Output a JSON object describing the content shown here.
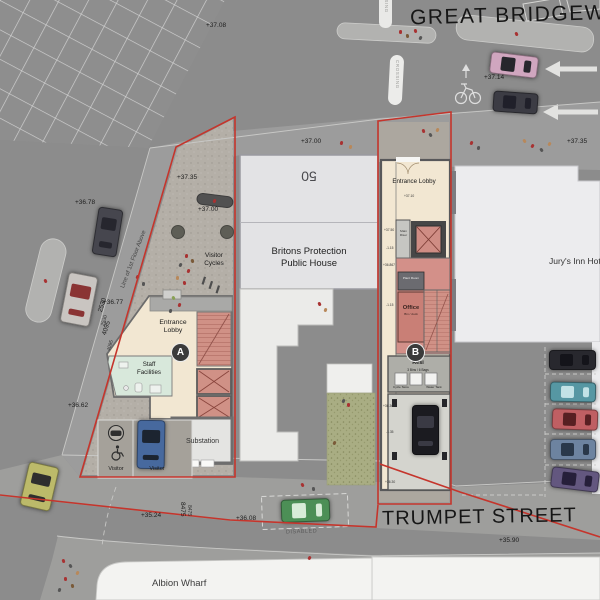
{
  "streets": {
    "top": "GREAT BRIDGEWATER",
    "bottom": "TRUMPET STREET"
  },
  "road": {
    "crossing": "CROSSING",
    "disabled_bay": "DISABLED"
  },
  "buildings": {
    "pub": {
      "number": "50",
      "name1": "Britons Protection",
      "name2": "Public House"
    },
    "hotel": {
      "name": "Jury's Inn Hotel"
    },
    "albion": {
      "name": "Albion Wharf"
    }
  },
  "site_a": {
    "marker": "A",
    "entrance_lobby": "Entrance Lobby",
    "staff_facilities": "Staff Facilities",
    "substation": "Substation",
    "visitor_left": "Visitor",
    "visitor_right": "Visitor",
    "visitor_cycles": "Visitor Cycles",
    "line_note": "Line of 1st Floor Above",
    "dim_edge_1": "2530",
    "dim_edge_2": "4095",
    "dim_street": "8475"
  },
  "site_b": {
    "marker": "B",
    "entrance_lobby": "Entrance Lobby",
    "main_riser": "Main Riser",
    "plant_room": "Plant Room",
    "office": "Office",
    "office_sub": "Bin / dock",
    "resi": "Resi",
    "resi_sub": "3 Bins / 6 Bags",
    "cycle_store": "Cycle Store",
    "water_tank": "Water Tank"
  },
  "levels": [
    {
      "t": "+37.08",
      "x": 206,
      "y": 22,
      "r": 0
    },
    {
      "t": "+37.14",
      "x": 484,
      "y": 74,
      "r": 0
    },
    {
      "t": "+37.35",
      "x": 567,
      "y": 138,
      "r": 0
    },
    {
      "t": "+37.35",
      "x": 177,
      "y": 174,
      "r": 0
    },
    {
      "t": "+37.00",
      "x": 198,
      "y": 206,
      "r": 0
    },
    {
      "t": "+37.00",
      "x": 301,
      "y": 138,
      "r": 0
    },
    {
      "t": "+36.78",
      "x": 75,
      "y": 199,
      "r": 0
    },
    {
      "t": "+36.77",
      "x": 103,
      "y": 299,
      "r": 0
    },
    {
      "t": "+36.62",
      "x": 68,
      "y": 402,
      "r": 0
    },
    {
      "t": "+35.24",
      "x": 141,
      "y": 512,
      "r": 0
    },
    {
      "t": "+36.08",
      "x": 236,
      "y": 515,
      "r": 0
    },
    {
      "t": "+35.90",
      "x": 499,
      "y": 537,
      "r": 0
    },
    {
      "t": "8475",
      "x": 186,
      "y": 502,
      "r": 90
    },
    {
      "t": "2530",
      "x": 97,
      "y": 311,
      "r": -73
    },
    {
      "t": "4095",
      "x": 101,
      "y": 334,
      "r": -73
    }
  ],
  "site_b_levels": [
    {
      "t": "+37.10",
      "x": 404,
      "y": 194
    },
    {
      "t": "+37.50",
      "x": 384,
      "y": 228
    },
    {
      "t": "-1.15",
      "x": 386,
      "y": 246
    },
    {
      "t": "+36.867",
      "x": 383,
      "y": 263
    },
    {
      "t": "-1.15",
      "x": 386,
      "y": 303
    },
    {
      "t": "+36.367",
      "x": 383,
      "y": 404
    },
    {
      "t": "-1.35",
      "x": 386,
      "y": 430
    },
    {
      "t": "+36.30",
      "x": 385,
      "y": 480
    }
  ],
  "colors": {
    "site_boundary": "#c5352c",
    "room_beige": "#f2e7d2",
    "room_red": "#d29089",
    "room_green": "#d8e8db",
    "grass": "#a9ad83",
    "road": "#8c8c8c",
    "pavement": "#9d9d9b"
  },
  "cars": [
    {
      "x": 490,
      "y": 54,
      "w": 46,
      "h": 20,
      "r": 7,
      "b": "#d0a6bf",
      "g": "#26262c"
    },
    {
      "x": 493,
      "y": 92,
      "w": 43,
      "h": 19,
      "r": 4,
      "b": "#3c3c44",
      "g": "#20202a"
    },
    {
      "x": 95,
      "y": 208,
      "w": 23,
      "h": 46,
      "r": 9,
      "b": "#46464e",
      "g": "#26262e"
    },
    {
      "x": 64,
      "y": 274,
      "w": 28,
      "h": 49,
      "r": 11,
      "b": "#c9c5c1",
      "g": "#8a3434"
    },
    {
      "x": 24,
      "y": 464,
      "w": 29,
      "h": 43,
      "r": 13,
      "b": "#bcba6a",
      "g": "#2e2e2e"
    },
    {
      "x": 137,
      "y": 420,
      "w": 26,
      "h": 47,
      "r": 1,
      "b": "#47699e",
      "g": "#1c2430"
    },
    {
      "x": 412,
      "y": 405,
      "w": 25,
      "h": 48,
      "r": 0,
      "b": "#1b1b20",
      "g": "#3a3a44"
    },
    {
      "x": 281,
      "y": 499,
      "w": 47,
      "h": 21,
      "r": -2,
      "b": "#4c8f56",
      "g": "#d8ecd8"
    },
    {
      "x": 549,
      "y": 350,
      "w": 45,
      "h": 18,
      "r": 0,
      "b": "#28282e",
      "g": "#14141a"
    },
    {
      "x": 550,
      "y": 382,
      "w": 44,
      "h": 18,
      "r": 1,
      "b": "#5697a3",
      "g": "#c2e2e6"
    },
    {
      "x": 552,
      "y": 409,
      "w": 44,
      "h": 19,
      "r": 2,
      "b": "#bf5f63",
      "g": "#571f22"
    },
    {
      "x": 550,
      "y": 439,
      "w": 44,
      "h": 19,
      "r": 0,
      "b": "#6d83a0",
      "g": "#2a384a"
    },
    {
      "x": 551,
      "y": 469,
      "w": 46,
      "h": 19,
      "r": 7,
      "b": "#63577f",
      "g": "#261f3a"
    }
  ],
  "figures": [
    [
      399,
      30,
      "#a83232"
    ],
    [
      406,
      34,
      "#7a5a38"
    ],
    [
      414,
      29,
      "#a83232"
    ],
    [
      419,
      36,
      "#555555"
    ],
    [
      515,
      32,
      "#a83232"
    ],
    [
      470,
      141,
      "#a83232"
    ],
    [
      477,
      146,
      "#555555"
    ],
    [
      523,
      139,
      "#b8885a"
    ],
    [
      531,
      144,
      "#a83232"
    ],
    [
      540,
      148,
      "#555555"
    ],
    [
      548,
      142,
      "#b8885a"
    ],
    [
      340,
      141,
      "#a83232"
    ],
    [
      349,
      145,
      "#b8885a"
    ],
    [
      185,
      254,
      "#a83232"
    ],
    [
      191,
      259,
      "#7a5a38"
    ],
    [
      179,
      263,
      "#555555"
    ],
    [
      187,
      269,
      "#a83232"
    ],
    [
      176,
      276,
      "#b8885a"
    ],
    [
      183,
      281,
      "#a83232"
    ],
    [
      172,
      296,
      "#88a055"
    ],
    [
      178,
      303,
      "#a83232"
    ],
    [
      169,
      309,
      "#555555"
    ],
    [
      136,
      275,
      "#a83232"
    ],
    [
      142,
      282,
      "#555555"
    ],
    [
      213,
      199,
      "#a83232"
    ],
    [
      318,
      302,
      "#a83232"
    ],
    [
      324,
      308,
      "#b8885a"
    ],
    [
      342,
      399,
      "#555555"
    ],
    [
      347,
      403,
      "#a83232"
    ],
    [
      333,
      441,
      "#7a5a38"
    ],
    [
      301,
      483,
      "#a83232"
    ],
    [
      312,
      487,
      "#555555"
    ],
    [
      308,
      556,
      "#a83232"
    ],
    [
      62,
      559,
      "#a83232"
    ],
    [
      69,
      564,
      "#555555"
    ],
    [
      76,
      571,
      "#b8885a"
    ],
    [
      64,
      577,
      "#a83232"
    ],
    [
      71,
      584,
      "#7a5a38"
    ],
    [
      58,
      588,
      "#555555"
    ],
    [
      422,
      129,
      "#a83232"
    ],
    [
      429,
      133,
      "#555555"
    ],
    [
      436,
      128,
      "#b8885a"
    ],
    [
      44,
      279,
      "#a83232"
    ]
  ]
}
